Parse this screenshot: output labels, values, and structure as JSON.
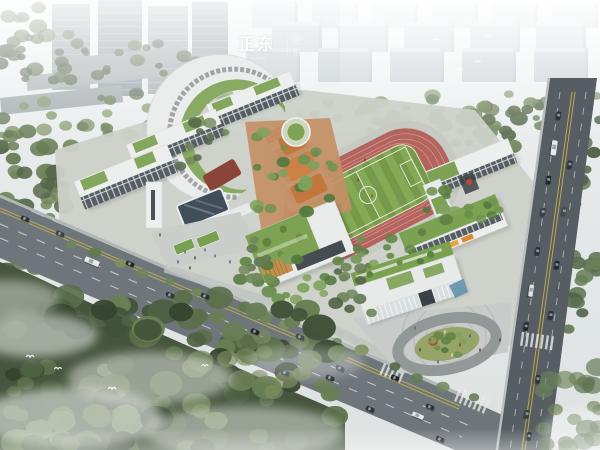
{
  "image": {
    "alt": "Aerial architectural rendering of a school campus: curved and slab classroom buildings with green roofs, central courtyard, athletics track with striped field, basketball courts, entrance pavilion and plaza, surrounded by tree-lined roads with traffic, dense misty forest at lower left, and a gray city skyline fading into fog at the top"
  },
  "watermark": {
    "brand": "正东",
    "tagline": "EST Vision",
    "vertical": "视觉"
  },
  "palette": {
    "fog_white": "#ffffff",
    "sky_gray": "#e9edee",
    "city_far": "#c9d0d4",
    "city_near": "#9da5aa",
    "road_asphalt": "#6f767b",
    "road_dark": "#575e63",
    "lane_yellow": "#c9b74b",
    "building_white": "#eceeed",
    "window_dark": "#535b61",
    "roof_green": "#7da253",
    "track_red": "#b4645c",
    "field_green": "#7ba04e",
    "court_orange": "#c5764b",
    "courtyard_terracotta": "#c49066",
    "plaza_gray": "#c8cbc9",
    "water_blue": "#6d9ab0",
    "glass_blue": "#3f4e58",
    "accent_red": "#ad5340",
    "awning_orange": "#e8a43a",
    "forest_dark": "#46553d",
    "foliage_mid": "#5d7349",
    "mist_white": "#f4f7f6"
  }
}
